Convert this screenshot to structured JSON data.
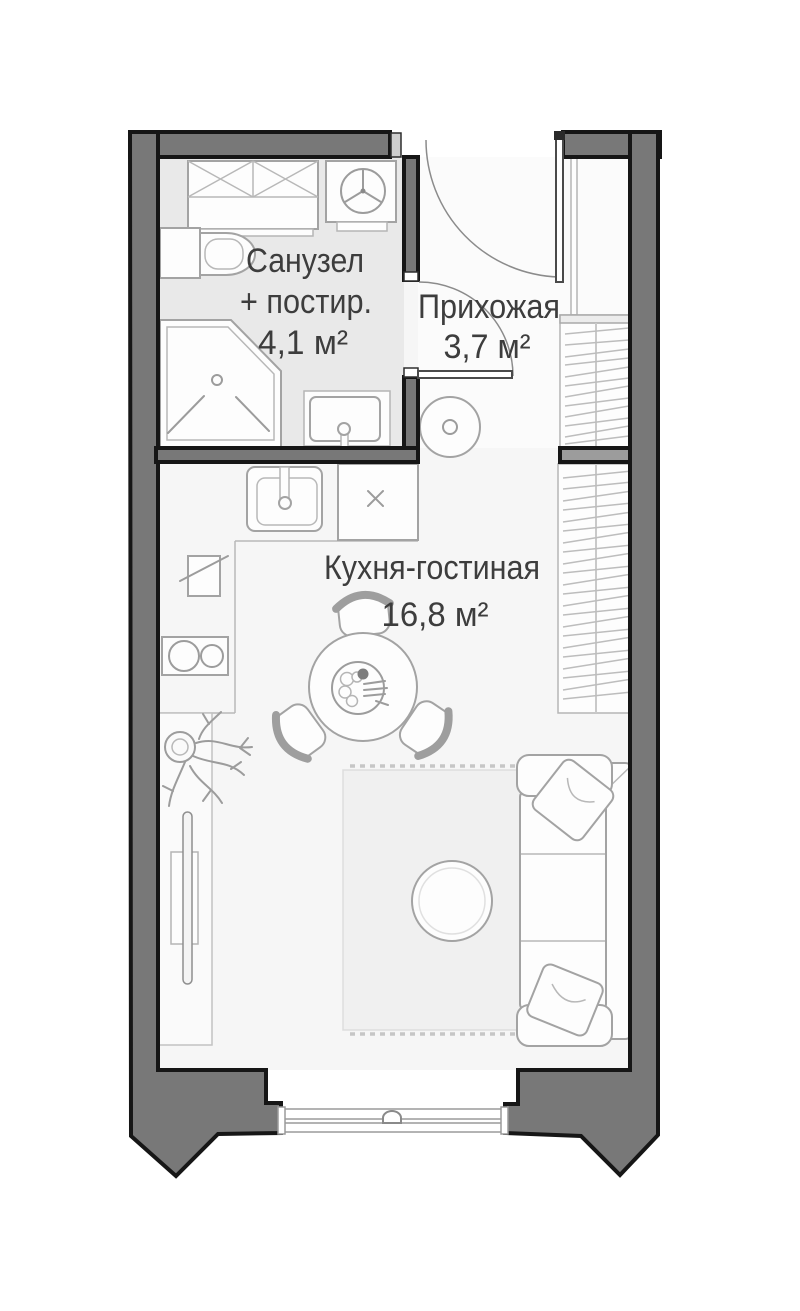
{
  "plan": {
    "title": "Studio apartment floor plan",
    "language": "ru",
    "rooms": [
      {
        "name": "Санузел + постир.",
        "label_line1": "Санузел",
        "label_line2": "+ постир.",
        "area_label": "4,1 м²",
        "area_m2": 4.1
      },
      {
        "name": "Прихожая",
        "label_line1": "Прихожая",
        "area_label": "3,7 м²",
        "area_m2": 3.7
      },
      {
        "name": "Кухня-гостиная",
        "label_line1": "Кухня-гостиная",
        "area_label": "16,8 м²",
        "area_m2": 16.8
      }
    ],
    "colors": {
      "wall": "#787878",
      "wall_outline": "#161616",
      "divider_wall": "#9c9c9c",
      "floor": "#f6f6f6",
      "hall_floor": "#fbfbfb",
      "bathroom_floor": "#e9e9e9",
      "rug": "#f0f0f0",
      "furniture_line": "#a3a3a3",
      "text": "#3d3d3d"
    }
  }
}
